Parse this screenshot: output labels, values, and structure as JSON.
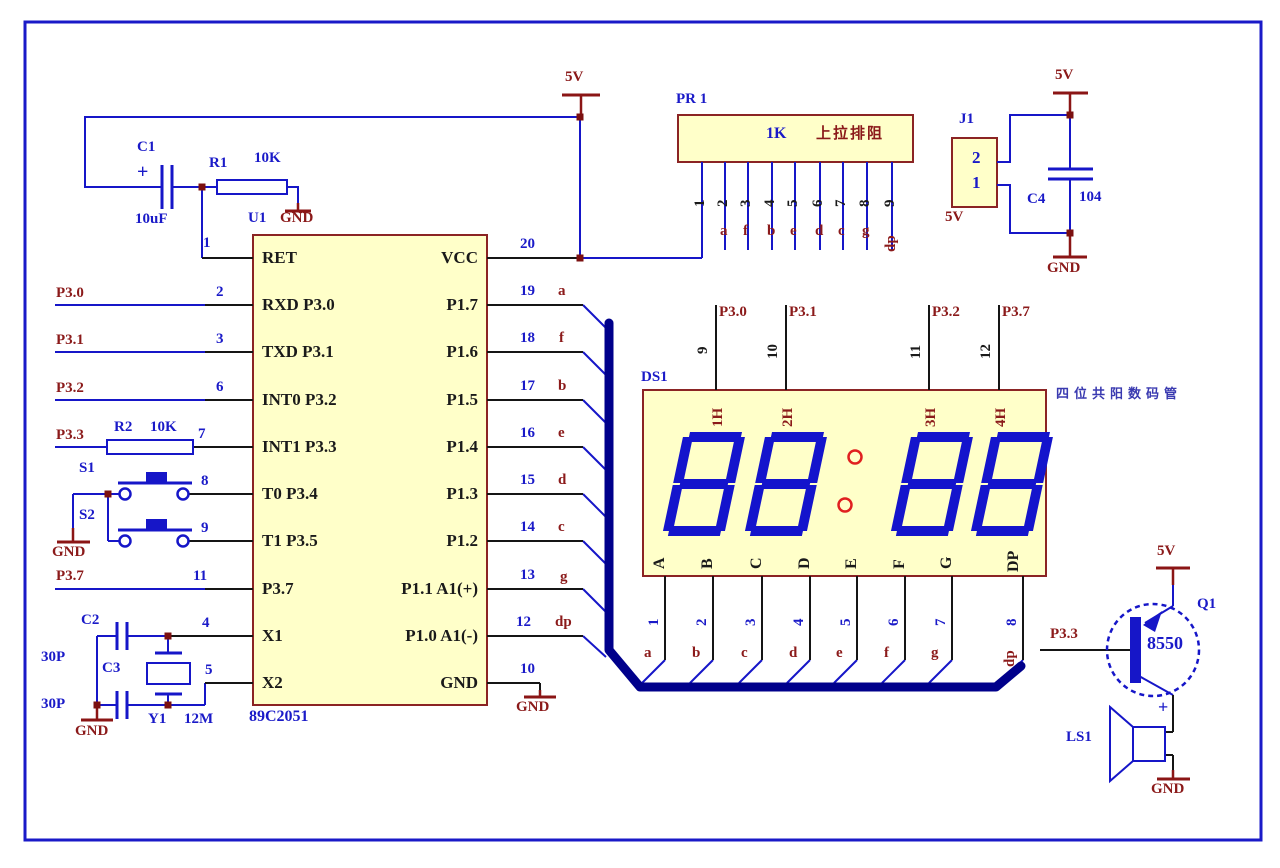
{
  "power": {
    "v5": "5V",
    "gnd": "GND"
  },
  "reset": {
    "c1": "C1",
    "c1_val": "10uF",
    "plus": "+",
    "r1": "R1",
    "r1_val": "10K"
  },
  "u1": {
    "ref": "U1",
    "part": "89C2051",
    "left": [
      {
        "num": "1",
        "label": "RET"
      },
      {
        "num": "2",
        "label": "RXD P3.0"
      },
      {
        "num": "3",
        "label": "TXD P3.1"
      },
      {
        "num": "6",
        "label": "INT0 P3.2"
      },
      {
        "num": "7",
        "label": "INT1 P3.3"
      },
      {
        "num": "8",
        "label": "T0 P3.4"
      },
      {
        "num": "9",
        "label": "T1 P3.5"
      },
      {
        "num": "11",
        "label": "P3.7"
      },
      {
        "num": "4",
        "label": "X1"
      },
      {
        "num": "5",
        "label": "X2"
      }
    ],
    "right": [
      {
        "num": "20",
        "label": "VCC",
        "seg": ""
      },
      {
        "num": "19",
        "label": "P1.7",
        "seg": "a"
      },
      {
        "num": "18",
        "label": "P1.6",
        "seg": "f"
      },
      {
        "num": "17",
        "label": "P1.5",
        "seg": "b"
      },
      {
        "num": "16",
        "label": "P1.4",
        "seg": "e"
      },
      {
        "num": "15",
        "label": "P1.3",
        "seg": "d"
      },
      {
        "num": "14",
        "label": "P1.2",
        "seg": "c"
      },
      {
        "num": "13",
        "label": "P1.1 A1(+)",
        "seg": "g"
      },
      {
        "num": "12",
        "label": "P1.0 A1(-)",
        "seg": "dp"
      },
      {
        "num": "10",
        "label": "GND",
        "seg": ""
      }
    ]
  },
  "nets": {
    "p30": "P3.0",
    "p31": "P3.1",
    "p32": "P3.2",
    "p33": "P3.3",
    "p37": "P3.7"
  },
  "r2": {
    "ref": "R2",
    "val": "10K"
  },
  "s1": {
    "ref": "S1"
  },
  "s2": {
    "ref": "S2"
  },
  "osc": {
    "c2": "C2",
    "c2_val": "30P",
    "c3": "C3",
    "c3_val": "30P",
    "y1": "Y1",
    "y1_val": "12M"
  },
  "pr1": {
    "ref": "PR 1",
    "val": "1K",
    "note": "上拉排阻",
    "nums": [
      "1",
      "2",
      "3",
      "4",
      "5",
      "6",
      "7",
      "8",
      "9"
    ],
    "segs": [
      "a",
      "f",
      "b",
      "e",
      "d",
      "c",
      "g",
      "dp"
    ]
  },
  "j1": {
    "ref": "J1",
    "p2": "2",
    "p1": "1",
    "net": "5V"
  },
  "c4": {
    "ref": "C4",
    "val": "104"
  },
  "ds1": {
    "ref": "DS1",
    "note": "四位共阳数码管",
    "top": [
      {
        "num": "9",
        "net": "P3.0"
      },
      {
        "num": "10",
        "net": "P3.1"
      },
      {
        "num": "11",
        "net": "P3.2"
      },
      {
        "num": "12",
        "net": "P3.7"
      }
    ],
    "digits": [
      "1H",
      "2H",
      "3H",
      "4H"
    ],
    "segs": [
      "A",
      "B",
      "C",
      "D",
      "E",
      "F",
      "G",
      "DP"
    ],
    "bottom": [
      {
        "num": "1",
        "seg": "a"
      },
      {
        "num": "2",
        "seg": "b"
      },
      {
        "num": "3",
        "seg": "c"
      },
      {
        "num": "4",
        "seg": "d"
      },
      {
        "num": "5",
        "seg": "e"
      },
      {
        "num": "6",
        "seg": "f"
      },
      {
        "num": "7",
        "seg": "g"
      },
      {
        "num": "8",
        "seg": "dp"
      }
    ]
  },
  "q1": {
    "ref": "Q1",
    "val": "8550",
    "base_net": "P3.3"
  },
  "ls1": {
    "ref": "LS1",
    "plus": "+"
  },
  "colors": {
    "wire_blue": "#1616C8",
    "bus_navy": "#00008B",
    "dark_red": "#8B1515",
    "box_fill": "#FFFFC9",
    "box_border": "#8B2424",
    "digit_blue": "#1414CC",
    "colon_red": "#E02020"
  }
}
